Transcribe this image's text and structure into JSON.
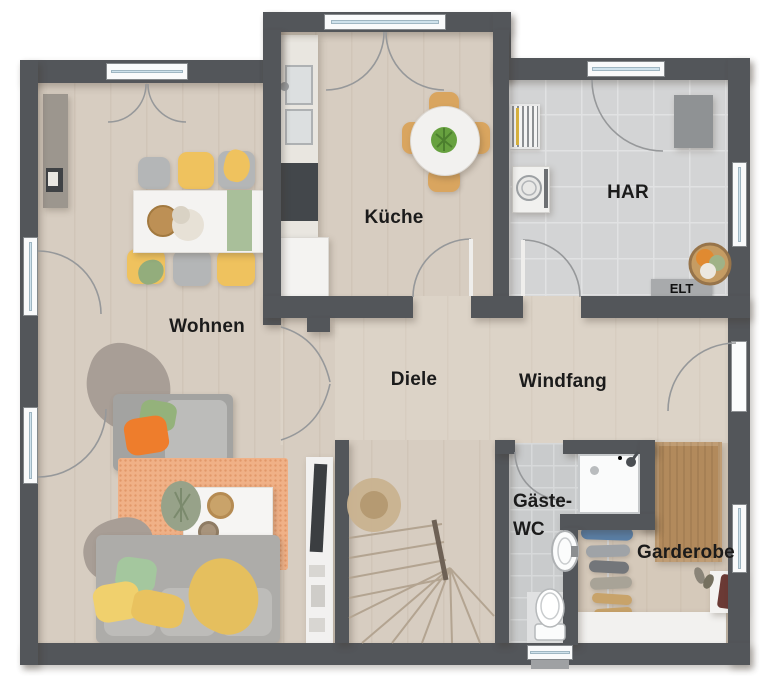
{
  "rooms": {
    "wohnen": {
      "label": "Wohnen"
    },
    "kueche": {
      "label": "Küche"
    },
    "har": {
      "label": "HAR"
    },
    "elt": {
      "label": "ELT"
    },
    "diele": {
      "label": "Diele"
    },
    "windfang": {
      "label": "Windfang"
    },
    "gaeste_wc": {
      "label_line1": "Gäste-",
      "label_line2": "WC"
    },
    "garderobe": {
      "label": "Garderobe"
    }
  },
  "colors": {
    "wall": "#53565a",
    "wood_floor": "#d7cdc1",
    "hall_floor": "#dcd3c7",
    "tile_har": "#d3d4d5",
    "tile_wc": "#c9cbcc",
    "window_glass": "#cfe2ec",
    "rug_living": "#f0b187",
    "rug_garderobe": "#b28a5c",
    "sofa_grey": "#abaaa7",
    "accent_orange": "#ee7d2c",
    "accent_yellow": "#efc25e",
    "accent_green": "#9cb983",
    "chair_wood": "#d9a55f"
  }
}
